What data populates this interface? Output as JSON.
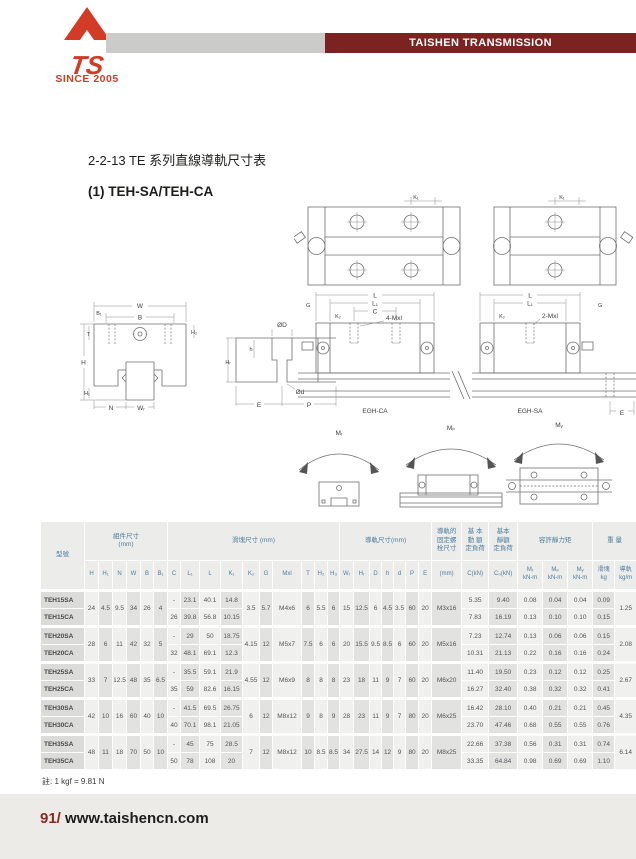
{
  "header": {
    "brand": "TAISHEN TRANSMISSION",
    "since": "SINCE 2005",
    "logo_text": "TS",
    "colors": {
      "brand_red": "#d23c27",
      "banner_maroon": "#7b2320",
      "bar_gray": "#cbcbc9"
    }
  },
  "page": {
    "title_line": "2-2-13  TE 系列直線導軌尺寸表",
    "subtitle": "(1) TEH-SA/TEH-CA",
    "note": "註: 1 kgf = 9.81 N",
    "page_number": "91/",
    "website": "www.taishencn.com"
  },
  "drawings": {
    "labels": {
      "k1": "K₁",
      "w": "W",
      "b": "B",
      "b1": "B₁",
      "t": "T",
      "h_total": "H",
      "h1": "H₁",
      "h2": "H₂",
      "n": "N",
      "wr": "Wᵣ",
      "od_big": "ØD",
      "od_small": "Ød",
      "h_small": "h",
      "hr": "Hᵣ",
      "e": "E",
      "p": "P",
      "g": "G",
      "k2": "K₂",
      "l": "L",
      "l1": "L₁",
      "c": "C",
      "mxl4": "4-Mxl",
      "mxl2": "2-Mxl",
      "egh_ca": "EGH-CA",
      "egh_sa": "EGH-SA",
      "mr": "Mᵣ",
      "mp": "Mₚ",
      "my": "Mᵧ"
    }
  },
  "table": {
    "model_header": "型號",
    "groups": [
      {
        "label": "組件尺寸\n(mm)",
        "colspan": 6
      },
      {
        "label": "滑塊尺寸 (mm)",
        "colspan": 10
      },
      {
        "label": "導軌尺寸(mm)",
        "colspan": 7
      },
      {
        "label": "導軌的\n固定螺\n栓尺寸",
        "colspan": 1
      },
      {
        "label": "基 本\n動 額\n定負荷",
        "colspan": 1
      },
      {
        "label": "基本\n靜額\n定負荷",
        "colspan": 1
      },
      {
        "label": "容許靜力矩",
        "colspan": 3
      },
      {
        "label": "重 量",
        "colspan": 2
      }
    ],
    "sub_headers": [
      "H",
      "H₁",
      "N",
      "W",
      "B",
      "B₁",
      "C",
      "L₁",
      "L",
      "K₁",
      "K₂",
      "G",
      "Mxl",
      "T",
      "H₂",
      "H₃",
      "Wᵣ",
      "Hᵣ",
      "D",
      "h",
      "d",
      "P",
      "E",
      "(mm)",
      "C(kN)",
      "C₀(kN)",
      "Mᵣ\nkN-m",
      "Mₚ\nkN-m",
      "Mᵧ\nkN-m",
      "滑塊\nkg",
      "導軌\nkg/m"
    ],
    "rows": [
      {
        "models": [
          "TEH15SA",
          "TEH15CA"
        ],
        "shared": {
          "H": "24",
          "H1": "4.5",
          "N": "9.5",
          "W": "34",
          "B": "26",
          "B1": "4",
          "K2": "3.5",
          "G": "5.7",
          "Mxl": "M4x6",
          "T": "6",
          "H2": "5.5",
          "H3": "6",
          "WR": "15",
          "HR": "12.5",
          "D": "6",
          "h": "4.5",
          "d": "3.5",
          "P": "60",
          "E": "20",
          "bolt": "M3x16",
          "rail_kg": "1.25"
        },
        "variants": [
          {
            "C": "-",
            "L1": "23.1",
            "L": "40.1",
            "K1": "14.8",
            "CkN": "5.35",
            "C0kN": "9.40",
            "MR": "0.08",
            "MP": "0.04",
            "MY": "0.04",
            "block_kg": "0.09"
          },
          {
            "C": "26",
            "L1": "39.8",
            "L": "56.8",
            "K1": "10.15",
            "CkN": "7.83",
            "C0kN": "16.19",
            "MR": "0.13",
            "MP": "0.10",
            "MY": "0.10",
            "block_kg": "0.15"
          }
        ]
      },
      {
        "models": [
          "TEH20SA",
          "TEH20CA"
        ],
        "shared": {
          "H": "28",
          "H1": "6",
          "N": "11",
          "W": "42",
          "B": "32",
          "B1": "5",
          "K2": "4.15",
          "G": "12",
          "Mxl": "M5x7",
          "T": "7.5",
          "H2": "6",
          "H3": "6",
          "WR": "20",
          "HR": "15.5",
          "D": "9.5",
          "h": "8.5",
          "d": "6",
          "P": "60",
          "E": "20",
          "bolt": "M5x16",
          "rail_kg": "2.08"
        },
        "variants": [
          {
            "C": "-",
            "L1": "29",
            "L": "50",
            "K1": "18.75",
            "CkN": "7.23",
            "C0kN": "12.74",
            "MR": "0.13",
            "MP": "0.06",
            "MY": "0.06",
            "block_kg": "0.15"
          },
          {
            "C": "32",
            "L1": "48.1",
            "L": "69.1",
            "K1": "12.3",
            "CkN": "10.31",
            "C0kN": "21.13",
            "MR": "0.22",
            "MP": "0.16",
            "MY": "0.16",
            "block_kg": "0.24"
          }
        ]
      },
      {
        "models": [
          "TEH25SA",
          "TEH25CA"
        ],
        "shared": {
          "H": "33",
          "H1": "7",
          "N": "12.5",
          "W": "48",
          "B": "35",
          "B1": "6.5",
          "K2": "4.55",
          "G": "12",
          "Mxl": "M6x9",
          "T": "8",
          "H2": "8",
          "H3": "8",
          "WR": "23",
          "HR": "18",
          "D": "11",
          "h": "9",
          "d": "7",
          "P": "60",
          "E": "20",
          "bolt": "M6x20",
          "rail_kg": "2.67"
        },
        "variants": [
          {
            "C": "-",
            "L1": "35.5",
            "L": "59.1",
            "K1": "21.9",
            "CkN": "11.40",
            "C0kN": "19.50",
            "MR": "0.23",
            "MP": "0.12",
            "MY": "0.12",
            "block_kg": "0.25"
          },
          {
            "C": "35",
            "L1": "59",
            "L": "82.6",
            "K1": "16.15",
            "CkN": "16.27",
            "C0kN": "32.40",
            "MR": "0.38",
            "MP": "0.32",
            "MY": "0.32",
            "block_kg": "0.41"
          }
        ]
      },
      {
        "models": [
          "TEH30SA",
          "TEH30CA"
        ],
        "shared": {
          "H": "42",
          "H1": "10",
          "N": "16",
          "W": "60",
          "B": "40",
          "B1": "10",
          "K2": "6",
          "G": "12",
          "Mxl": "M8x12",
          "T": "9",
          "H2": "8",
          "H3": "9",
          "WR": "28",
          "HR": "23",
          "D": "11",
          "h": "9",
          "d": "7",
          "P": "80",
          "E": "20",
          "bolt": "M6x25",
          "rail_kg": "4.35"
        },
        "variants": [
          {
            "C": "-",
            "L1": "41.5",
            "L": "69.5",
            "K1": "26.75",
            "CkN": "16.42",
            "C0kN": "28.10",
            "MR": "0.40",
            "MP": "0.21",
            "MY": "0.21",
            "block_kg": "0.45"
          },
          {
            "C": "40",
            "L1": "70.1",
            "L": "98.1",
            "K1": "21.05",
            "CkN": "23.70",
            "C0kN": "47.46",
            "MR": "0.68",
            "MP": "0.55",
            "MY": "0.55",
            "block_kg": "0.76"
          }
        ]
      },
      {
        "models": [
          "TEH35SA",
          "TEH35CA"
        ],
        "shared": {
          "H": "48",
          "H1": "11",
          "N": "18",
          "W": "70",
          "B": "50",
          "B1": "10",
          "K2": "7",
          "G": "12",
          "Mxl": "M8x12",
          "T": "10",
          "H2": "8.5",
          "H3": "8.5",
          "WR": "34",
          "HR": "27.5",
          "D": "14",
          "h": "12",
          "d": "9",
          "P": "80",
          "E": "20",
          "bolt": "M8x25",
          "rail_kg": "6.14"
        },
        "variants": [
          {
            "C": "-",
            "L1": "45",
            "L": "75",
            "K1": "28.5",
            "CkN": "22.66",
            "C0kN": "37.38",
            "MR": "0.56",
            "MP": "0.31",
            "MY": "0.31",
            "block_kg": "0.74"
          },
          {
            "C": "50",
            "L1": "78",
            "L": "108",
            "K1": "20",
            "CkN": "33.35",
            "C0kN": "64.84",
            "MR": "0.98",
            "MP": "0.69",
            "MY": "0.69",
            "block_kg": "1.10"
          }
        ]
      }
    ]
  }
}
